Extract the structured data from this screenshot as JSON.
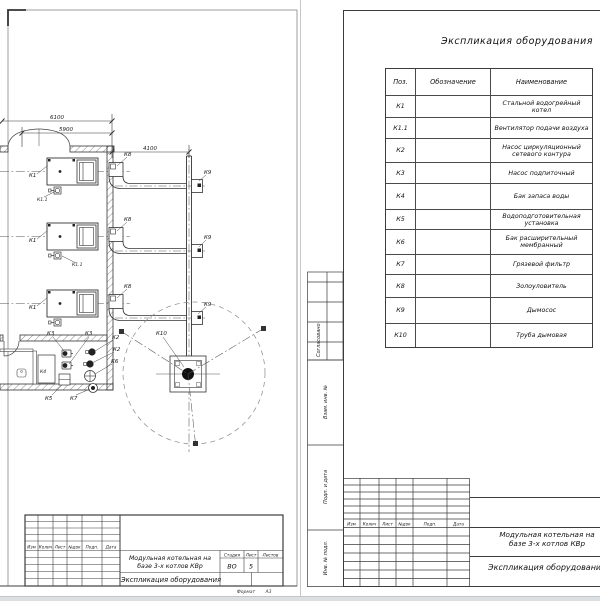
{
  "plan": {
    "dims": {
      "outer": "6100",
      "inner": "5900",
      "duct": "4100"
    },
    "labels": {
      "k1": "К1",
      "k1_1": "К1.1",
      "k2": "К2",
      "k3": "К3",
      "k4": "К4",
      "k5": "К5",
      "k6": "К6",
      "k7": "К7",
      "k8": "К8",
      "k9": "К9",
      "k10": "К10"
    }
  },
  "spec": {
    "title": "Экспликация оборудования",
    "headers": {
      "pos": "Поз.",
      "designation": "Обозначение",
      "name": "Наименование"
    },
    "rows": [
      {
        "pos": "К1",
        "designation": "",
        "name": "Стальной водогрейный котел"
      },
      {
        "pos": "К1.1",
        "designation": "",
        "name": "Вентилятор подачи воздуха"
      },
      {
        "pos": "К2",
        "designation": "",
        "name": "Насос циркуляционный сетевого контура"
      },
      {
        "pos": "К3",
        "designation": "",
        "name": "Насос подпиточный"
      },
      {
        "pos": "К4",
        "designation": "",
        "name": "Бак запаса воды"
      },
      {
        "pos": "К5",
        "designation": "",
        "name": "Водоподготовительная установка"
      },
      {
        "pos": "К6",
        "designation": "",
        "name": "Бак расширительный мембранный"
      },
      {
        "pos": "К7",
        "designation": "",
        "name": "Грязевой фильтр"
      },
      {
        "pos": "К8",
        "designation": "",
        "name": "Золоуловитель"
      },
      {
        "pos": "К9",
        "designation": "",
        "name": "Дымосос"
      },
      {
        "pos": "К10",
        "designation": "",
        "name": "Труба дымовая"
      }
    ]
  },
  "titleblock": {
    "rev_headers": [
      "Изм",
      "Колич",
      "Лист",
      "№док",
      "Подп.",
      "Дата"
    ],
    "project_line1": "Модульная котельная на",
    "project_line2": "базе 3-х котлов КВр",
    "doc_title": "Экспликация оборудования",
    "stage_label": "Стадия",
    "sheet_label": "Лист",
    "sheets_label": "Листов",
    "stage": "ВО",
    "sheet": "5",
    "format_label": "Формат",
    "format_value": "А3"
  },
  "margin": {
    "approved": "Согласовано",
    "vzam": "Взам. инв. №",
    "podp": "Подп. и дата",
    "inv": "Инв. № подл."
  }
}
